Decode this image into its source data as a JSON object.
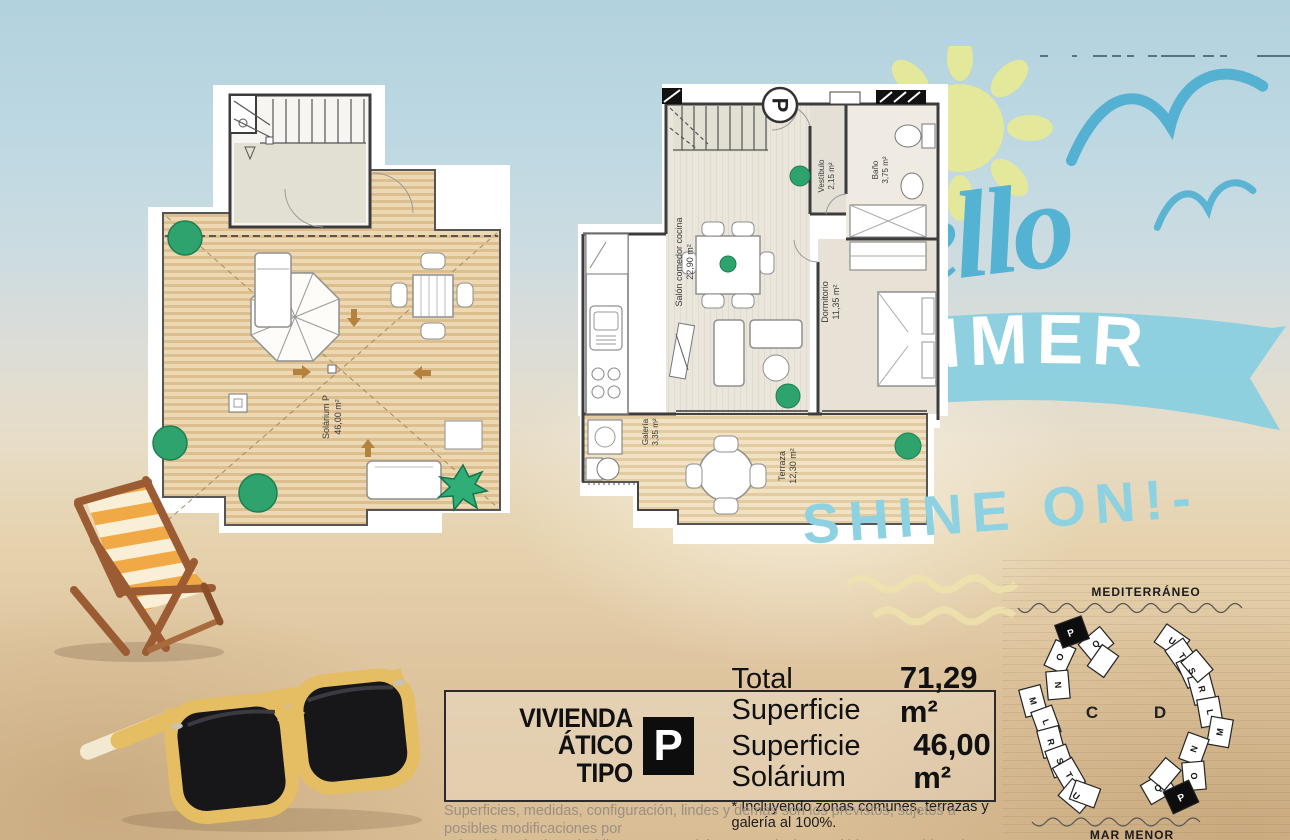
{
  "hero": {
    "script_word": "Hello",
    "banner_word": "SUMMER",
    "tagline": "SHINE ON!-"
  },
  "plans": {
    "solarium": {
      "name": "Solárium P",
      "area": "46,00 m²"
    },
    "main": {
      "marker": "P",
      "salon_name": "Salón comedor cocina",
      "salon_area": "22,90 m²",
      "vestibulo_name": "Vestíbulo",
      "vestibulo_area": "2,15 m²",
      "bano_name": "Baño",
      "bano_area": "3,75 m²",
      "dormitorio_name": "Dormitorio",
      "dormitorio_area": "11,35 m²",
      "galeria_name": "Galería",
      "galeria_area": "3,35 m²",
      "terraza_name": "Terraza",
      "terraza_area": "12,30 m²"
    }
  },
  "info_box": {
    "dwelling_line1": "VIVIENDA",
    "dwelling_line2": "ÁTICO TIPO",
    "type_letter": "P",
    "total_label": "Total Superficie",
    "total_value": "71,29 m²",
    "solarium_label": "Superficie Solárium",
    "solarium_value": "46,00 m²",
    "footnote": "* Incluyendo zonas comunes, terrazas y galería al 100%."
  },
  "disclaimer_line1": "Superficies, medidas, configuración, lindes y demás son los previstos, sujetos a posibles modificaciones por",
  "disclaimer_line2": "exigencias técnicas, jurídicas o comerciales. No se incluyen ni bienes muebles ni elementos de jardinería.",
  "site_plan": {
    "sea_label": "MEDITERRÁNEO",
    "lagoon_label": "MAR MENOR",
    "building_c": {
      "name": "C",
      "units": [
        "P",
        "Q",
        "O",
        "N",
        "M",
        "L",
        "R",
        "S",
        "T",
        "U"
      ]
    },
    "building_d": {
      "name": "D",
      "units": [
        "U",
        "T",
        "S",
        "R",
        "L",
        "M",
        "N",
        "O",
        "Q",
        "P"
      ]
    },
    "highlighted_unit": "P"
  },
  "colors": {
    "script_blue": "#54b2d3",
    "ribbon_blue": "#8bcfe0",
    "tagline_blue": "#8ed2e2",
    "sun_yellow": "#e4e89a",
    "plan_green": "#2ea36e",
    "solarium_wood": "#e3c695",
    "terrace_wood": "#e2cba0",
    "highlight_black": "#0d0d0d"
  }
}
